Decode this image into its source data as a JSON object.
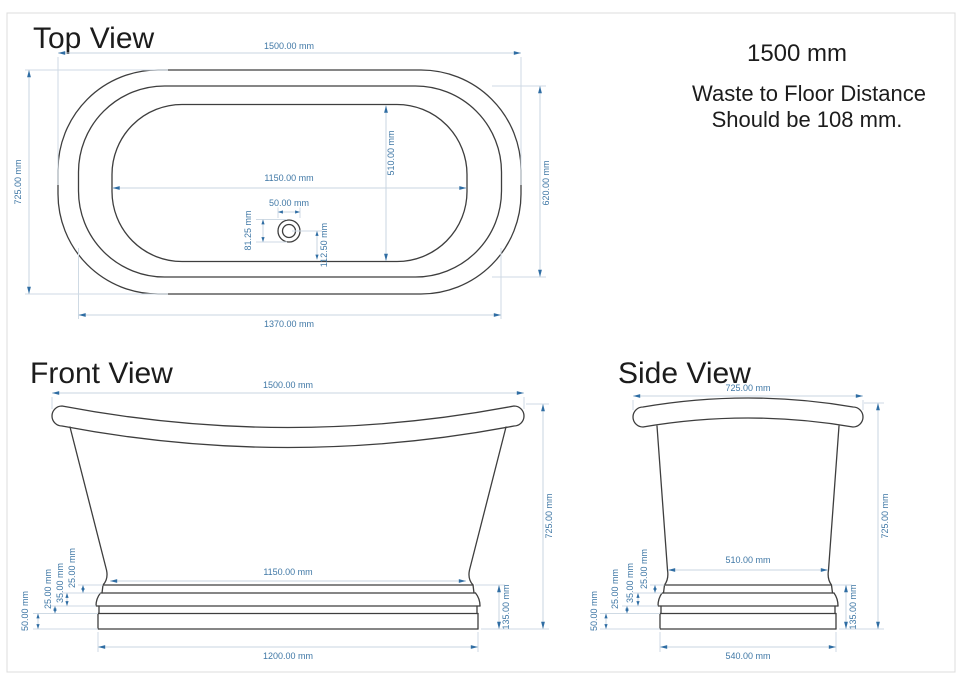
{
  "notes": {
    "size": "1500 mm",
    "waste_line1": "Waste to Floor Distance",
    "waste_line2": "Should be 108 mm."
  },
  "views": {
    "top": {
      "title": "Top View",
      "dims": {
        "overall_width": "1500.00 mm",
        "overall_depth": "725.00 mm",
        "rim_width": "1370.00 mm",
        "rim_depth": "620.00 mm",
        "basin_width": "1150.00 mm",
        "basin_depth": "510.00 mm",
        "drain_diameter": "50.00 mm",
        "drain_dim_left": "81.25 mm",
        "drain_to_basin_edge": "112.50 mm"
      }
    },
    "front": {
      "title": "Front View",
      "dims": {
        "overall_width": "1500.00 mm",
        "overall_height": "725.00 mm",
        "body_bottom_width": "1150.00 mm",
        "base_width": "1200.00 mm",
        "plinth_height": "135.00 mm",
        "band_1": "25.00 mm",
        "band_2": "35.00 mm",
        "band_3": "25.00 mm",
        "band_4": "50.00 mm"
      }
    },
    "side": {
      "title": "Side View",
      "dims": {
        "overall_depth": "725.00 mm",
        "overall_height": "725.00 mm",
        "body_bottom_depth": "510.00 mm",
        "base_depth": "540.00 mm",
        "plinth_height": "135.00 mm",
        "band_1": "25.00 mm",
        "band_2": "35.00 mm",
        "band_3": "25.00 mm",
        "band_4": "50.00 mm"
      }
    }
  },
  "colors": {
    "dimension_accent": "#2f6da3",
    "dimension_line": "#c9d6e2",
    "dimension_text": "#4078a6",
    "drawing_outline": "#3e3e3e",
    "page_border": "#dcdcdc"
  }
}
